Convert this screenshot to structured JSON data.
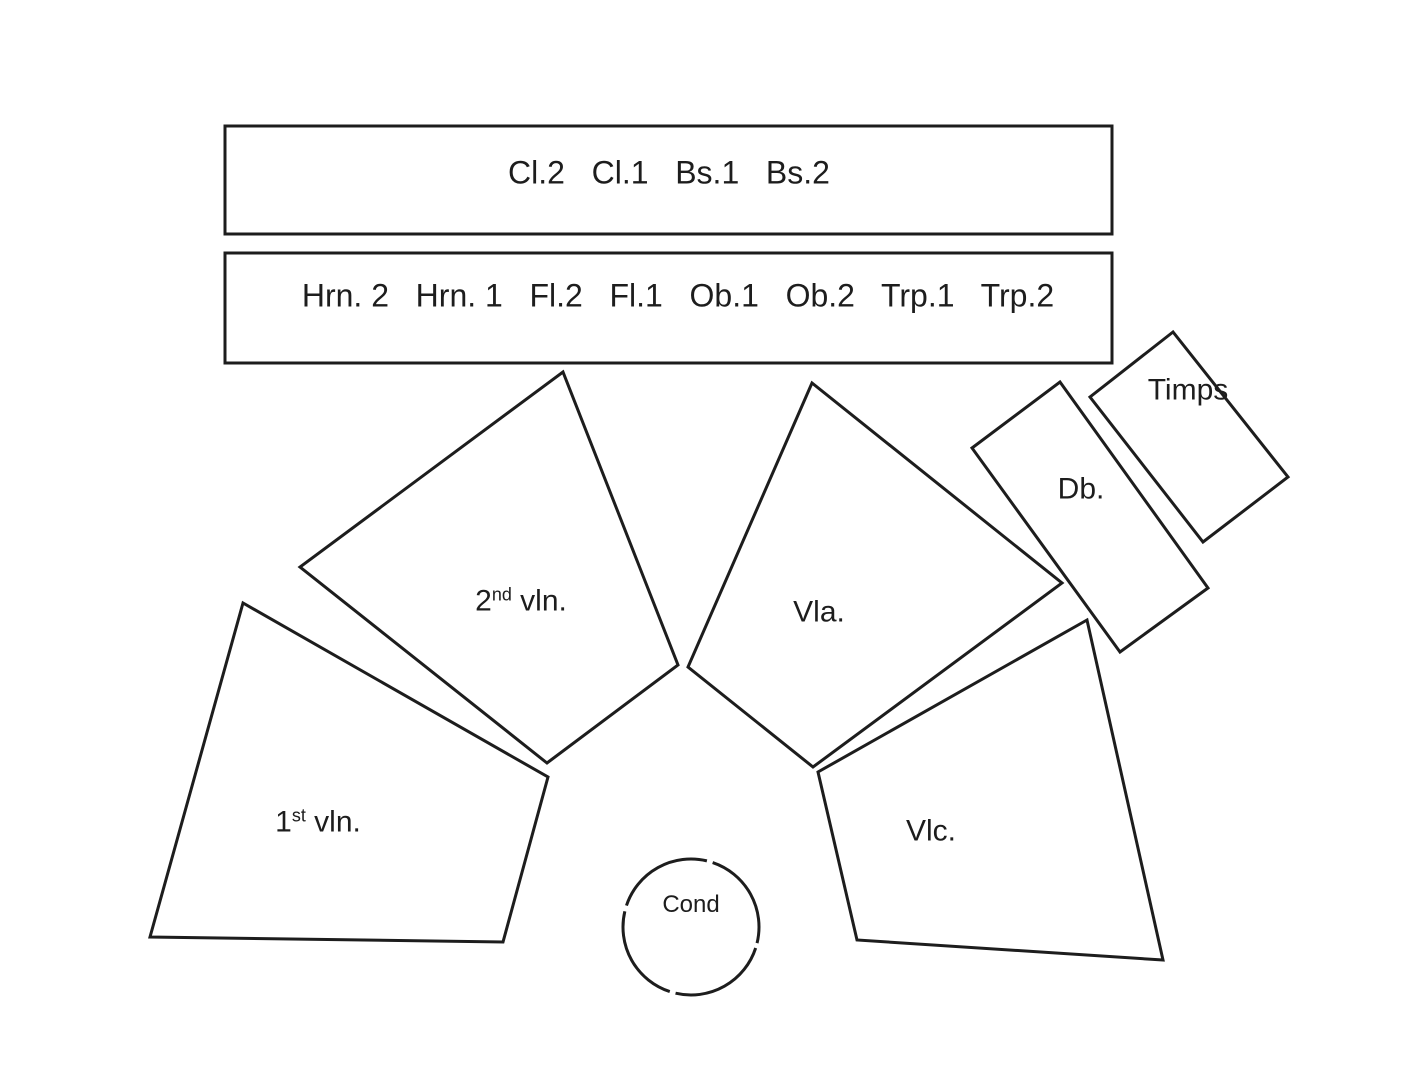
{
  "diagram": {
    "background": "#ffffff",
    "stroke_color": "#1d1d1d",
    "text_color": "#1d1d1d",
    "wind_rows": [
      {
        "label": "Cl.2   Cl.1   Bs.1   Bs.2"
      },
      {
        "label": "Hrn. 2   Hrn. 1   Fl.2   Fl.1   Ob.1   Ob.2   Trp.1   Trp.2"
      }
    ],
    "sections": {
      "second_violins": {
        "base": "2",
        "sup": "nd",
        "rest": " vln."
      },
      "first_violins": {
        "base": "1",
        "sup": "st",
        "rest": " vln."
      },
      "violas": {
        "label": "Vla."
      },
      "cellos": {
        "label": "Vlc."
      },
      "double_basses": {
        "label": "Db."
      },
      "timpani": {
        "label": "Timps"
      },
      "conductor": {
        "label": "Cond"
      }
    }
  }
}
